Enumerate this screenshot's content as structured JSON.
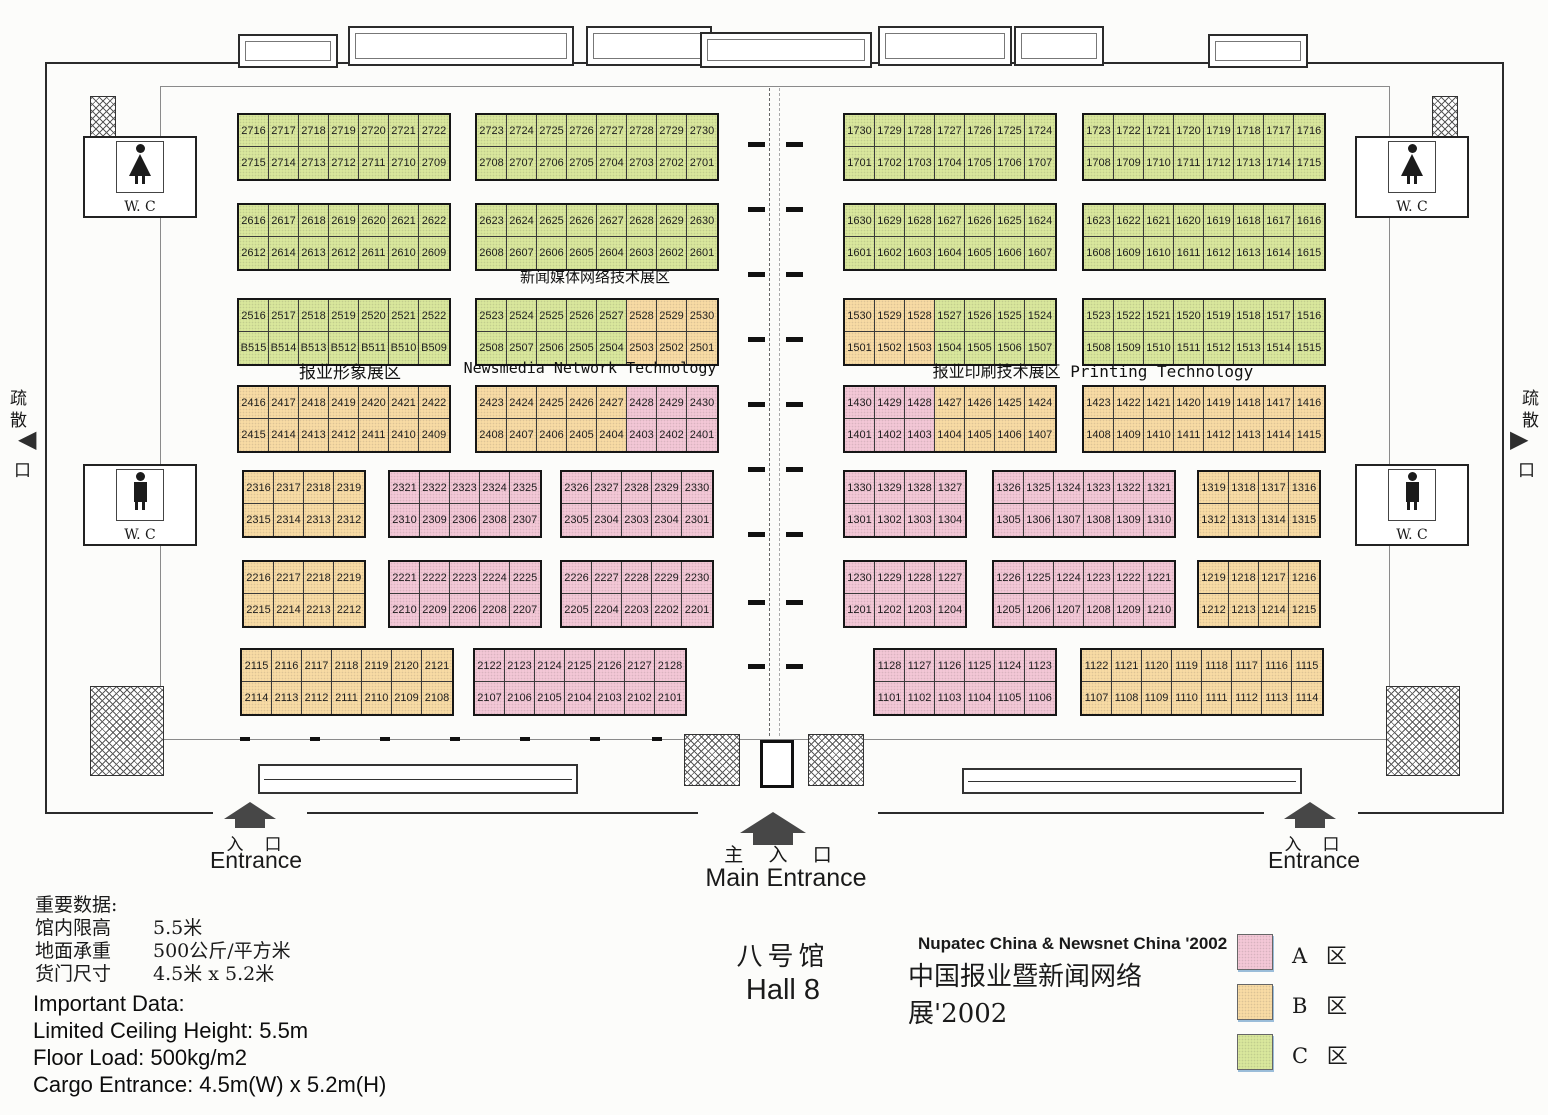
{
  "hall": {
    "title_cn": "八号馆",
    "title_en": "Hall 8"
  },
  "event": {
    "line_en": "Nupatec China & Newsnet China '2002",
    "line_cn": "中国报业暨新闻网络展'2002"
  },
  "legend": {
    "items": [
      {
        "label": "A 区",
        "zone": "A"
      },
      {
        "label": "B 区",
        "zone": "B"
      },
      {
        "label": "C 区",
        "zone": "C"
      }
    ]
  },
  "zone_colors": {
    "A": "#f3c7d6",
    "B": "#f8dba4",
    "C": "#d9e79c"
  },
  "area_labels": {
    "newsmedia_cn": "新闻媒体网络技术展区",
    "image_cn": "报业形象展区",
    "newsmedia_en": "Newsmedia Network Technology",
    "printing": "报业印刷技术展区 Printing Technology"
  },
  "entrances": {
    "left": {
      "cn": "入　口",
      "en": "Entrance"
    },
    "main": {
      "cn": "主 入 口",
      "en": "Main Entrance"
    },
    "right": {
      "cn": "入　口",
      "en": "Entrance"
    }
  },
  "evacuation": {
    "chars": [
      "疏",
      "散",
      "口"
    ]
  },
  "wc_label": "W. C",
  "important_data": {
    "cn": [
      {
        "label": "重要数据:",
        "value": ""
      },
      {
        "label": "馆内限高",
        "value": "5.5米"
      },
      {
        "label": "地面承重",
        "value": "500公斤/平方米"
      },
      {
        "label": "货门尺寸",
        "value": "4.5米 x 5.2米"
      }
    ],
    "en": [
      "Important Data:",
      "Limited Ceiling Height:  5.5m",
      "Floor Load:  500kg/m2",
      "Cargo Entrance:  4.5m(W) x 5.2m(H)"
    ]
  },
  "blocks": [
    {
      "x": 237,
      "y": 113,
      "zone": "C",
      "top": [
        "2716",
        "2717",
        "2718",
        "2719",
        "2720",
        "2721",
        "2722"
      ],
      "bottom": [
        "2715",
        "2714",
        "2713",
        "2712",
        "2711",
        "2710",
        "2709"
      ]
    },
    {
      "x": 475,
      "y": 113,
      "zone": "C",
      "top": [
        "2723",
        "2724",
        "2725",
        "2726",
        "2727",
        "2728",
        "2729",
        "2730"
      ],
      "bottom": [
        "2708",
        "2707",
        "2706",
        "2705",
        "2704",
        "2703",
        "2702",
        "2701"
      ]
    },
    {
      "x": 843,
      "y": 113,
      "zone": "C",
      "top": [
        "1730",
        "1729",
        "1728",
        "1727",
        "1726",
        "1725",
        "1724"
      ],
      "bottom": [
        "1701",
        "1702",
        "1703",
        "1704",
        "1705",
        "1706",
        "1707"
      ]
    },
    {
      "x": 1082,
      "y": 113,
      "zone": "C",
      "top": [
        "1723",
        "1722",
        "1721",
        "1720",
        "1719",
        "1718",
        "1717",
        "1716"
      ],
      "bottom": [
        "1708",
        "1709",
        "1710",
        "1711",
        "1712",
        "1713",
        "1714",
        "1715"
      ]
    },
    {
      "x": 237,
      "y": 203,
      "zone": "C",
      "top": [
        "2616",
        "2617",
        "2618",
        "2619",
        "2620",
        "2621",
        "2622"
      ],
      "bottom": [
        "2612",
        "2614",
        "2613",
        "2612",
        "2611",
        "2610",
        "2609"
      ]
    },
    {
      "x": 475,
      "y": 203,
      "zone": "C",
      "top": [
        "2623",
        "2624",
        "2625",
        "2626",
        "2627",
        "2628",
        "2629",
        "2630"
      ],
      "bottom": [
        "2608",
        "2607",
        "2606",
        "2605",
        "2604",
        "2603",
        "2602",
        "2601"
      ]
    },
    {
      "x": 843,
      "y": 203,
      "zone": "C",
      "top": [
        "1630",
        "1629",
        "1628",
        "1627",
        "1626",
        "1625",
        "1624"
      ],
      "bottom": [
        "1601",
        "1602",
        "1603",
        "1604",
        "1605",
        "1606",
        "1607"
      ]
    },
    {
      "x": 1082,
      "y": 203,
      "zone": "C",
      "top": [
        "1623",
        "1622",
        "1621",
        "1620",
        "1619",
        "1618",
        "1617",
        "1616"
      ],
      "bottom": [
        "1608",
        "1609",
        "1610",
        "1611",
        "1612",
        "1613",
        "1614",
        "1615"
      ]
    },
    {
      "x": 237,
      "y": 298,
      "zone": "C",
      "top": [
        "2516",
        "2517",
        "2518",
        "2519",
        "2520",
        "2521",
        "2522"
      ],
      "bottom": [
        "B515",
        "B514",
        "B513",
        "B512",
        "B511",
        "B510",
        "B509"
      ]
    },
    {
      "x": 475,
      "y": 298,
      "zt": "CCCCCBBB",
      "zb": "CCCCCBBB",
      "top": [
        "2523",
        "2524",
        "2525",
        "2526",
        "2527",
        "2528",
        "2529",
        "2530"
      ],
      "bottom": [
        "2508",
        "2507",
        "2506",
        "2505",
        "2504",
        "2503",
        "2502",
        "2501"
      ]
    },
    {
      "x": 843,
      "y": 298,
      "zt": "BBBCCCC",
      "zb": "BBBCCCC",
      "top": [
        "1530",
        "1529",
        "1528",
        "1527",
        "1526",
        "1525",
        "1524"
      ],
      "bottom": [
        "1501",
        "1502",
        "1503",
        "1504",
        "1505",
        "1506",
        "1507"
      ]
    },
    {
      "x": 1082,
      "y": 298,
      "zone": "C",
      "top": [
        "1523",
        "1522",
        "1521",
        "1520",
        "1519",
        "1518",
        "1517",
        "1516"
      ],
      "bottom": [
        "1508",
        "1509",
        "1510",
        "1511",
        "1512",
        "1513",
        "1514",
        "1515"
      ]
    },
    {
      "x": 237,
      "y": 385,
      "zone": "B",
      "top": [
        "2416",
        "2417",
        "2418",
        "2419",
        "2420",
        "2421",
        "2422"
      ],
      "bottom": [
        "2415",
        "2414",
        "2413",
        "2412",
        "2411",
        "2410",
        "2409"
      ]
    },
    {
      "x": 475,
      "y": 385,
      "zt": "BBBBBAAA",
      "zb": "BBBBBAAA",
      "top": [
        "2423",
        "2424",
        "2425",
        "2426",
        "2427",
        "2428",
        "2429",
        "2430"
      ],
      "bottom": [
        "2408",
        "2407",
        "2406",
        "2405",
        "2404",
        "2403",
        "2402",
        "2401"
      ]
    },
    {
      "x": 843,
      "y": 385,
      "zt": "AAABBBB",
      "zb": "AAABBBB",
      "top": [
        "1430",
        "1429",
        "1428",
        "1427",
        "1426",
        "1425",
        "1424"
      ],
      "bottom": [
        "1401",
        "1402",
        "1403",
        "1404",
        "1405",
        "1406",
        "1407"
      ]
    },
    {
      "x": 1082,
      "y": 385,
      "zone": "B",
      "top": [
        "1423",
        "1422",
        "1421",
        "1420",
        "1419",
        "1418",
        "1417",
        "1416"
      ],
      "bottom": [
        "1408",
        "1409",
        "1410",
        "1411",
        "1412",
        "1413",
        "1414",
        "1415"
      ]
    },
    {
      "x": 242,
      "y": 470,
      "zone": "B",
      "top": [
        "2316",
        "2317",
        "2318",
        "2319"
      ],
      "bottom": [
        "2315",
        "2314",
        "2313",
        "2312"
      ]
    },
    {
      "x": 388,
      "y": 470,
      "zone": "A",
      "top": [
        "2321",
        "2322",
        "2323",
        "2324",
        "2325"
      ],
      "bottom": [
        "2310",
        "2309",
        "2306",
        "2308",
        "2307"
      ]
    },
    {
      "x": 560,
      "y": 470,
      "zone": "A",
      "top": [
        "2326",
        "2327",
        "2328",
        "2329",
        "2330"
      ],
      "bottom": [
        "2305",
        "2304",
        "2303",
        "2304",
        "2301"
      ]
    },
    {
      "x": 843,
      "y": 470,
      "zone": "A",
      "top": [
        "1330",
        "1329",
        "1328",
        "1327"
      ],
      "bottom": [
        "1301",
        "1302",
        "1303",
        "1304"
      ]
    },
    {
      "x": 992,
      "y": 470,
      "zone": "A",
      "top": [
        "1326",
        "1325",
        "1324",
        "1323",
        "1322",
        "1321"
      ],
      "bottom": [
        "1305",
        "1306",
        "1307",
        "1308",
        "1309",
        "1310"
      ]
    },
    {
      "x": 1197,
      "y": 470,
      "zone": "B",
      "top": [
        "1319",
        "1318",
        "1317",
        "1316"
      ],
      "bottom": [
        "1312",
        "1313",
        "1314",
        "1315"
      ]
    },
    {
      "x": 242,
      "y": 560,
      "zone": "B",
      "top": [
        "2216",
        "2217",
        "2218",
        "2219"
      ],
      "bottom": [
        "2215",
        "2214",
        "2213",
        "2212"
      ]
    },
    {
      "x": 388,
      "y": 560,
      "zone": "A",
      "top": [
        "2221",
        "2222",
        "2223",
        "2224",
        "2225"
      ],
      "bottom": [
        "2210",
        "2209",
        "2206",
        "2208",
        "2207"
      ]
    },
    {
      "x": 560,
      "y": 560,
      "zone": "A",
      "top": [
        "2226",
        "2227",
        "2228",
        "2229",
        "2230"
      ],
      "bottom": [
        "2205",
        "2204",
        "2203",
        "2202",
        "2201"
      ]
    },
    {
      "x": 843,
      "y": 560,
      "zone": "A",
      "top": [
        "1230",
        "1229",
        "1228",
        "1227"
      ],
      "bottom": [
        "1201",
        "1202",
        "1203",
        "1204"
      ]
    },
    {
      "x": 992,
      "y": 560,
      "zone": "A",
      "top": [
        "1226",
        "1225",
        "1224",
        "1223",
        "1222",
        "1221"
      ],
      "bottom": [
        "1205",
        "1206",
        "1207",
        "1208",
        "1209",
        "1210"
      ]
    },
    {
      "x": 1197,
      "y": 560,
      "zone": "B",
      "top": [
        "1219",
        "1218",
        "1217",
        "1216"
      ],
      "bottom": [
        "1212",
        "1213",
        "1214",
        "1215"
      ]
    },
    {
      "x": 240,
      "y": 648,
      "zone": "B",
      "top": [
        "2115",
        "2116",
        "2117",
        "2118",
        "2119",
        "2120",
        "2121"
      ],
      "bottom": [
        "2114",
        "2113",
        "2112",
        "2111",
        "2110",
        "2109",
        "2108"
      ]
    },
    {
      "x": 473,
      "y": 648,
      "zone": "A",
      "top": [
        "2122",
        "2123",
        "2124",
        "2125",
        "2126",
        "2127",
        "2128"
      ],
      "bottom": [
        "2107",
        "2106",
        "2105",
        "2104",
        "2103",
        "2102",
        "2101"
      ]
    },
    {
      "x": 873,
      "y": 648,
      "zone": "A",
      "top": [
        "1128",
        "1127",
        "1126",
        "1125",
        "1124",
        "1123"
      ],
      "bottom": [
        "1101",
        "1102",
        "1103",
        "1104",
        "1105",
        "1106"
      ]
    },
    {
      "x": 1080,
      "y": 648,
      "zone": "B",
      "top": [
        "1122",
        "1121",
        "1120",
        "1119",
        "1118",
        "1117",
        "1116",
        "1115"
      ],
      "bottom": [
        "1107",
        "1108",
        "1109",
        "1110",
        "1111",
        "1112",
        "1113",
        "1114"
      ]
    }
  ]
}
